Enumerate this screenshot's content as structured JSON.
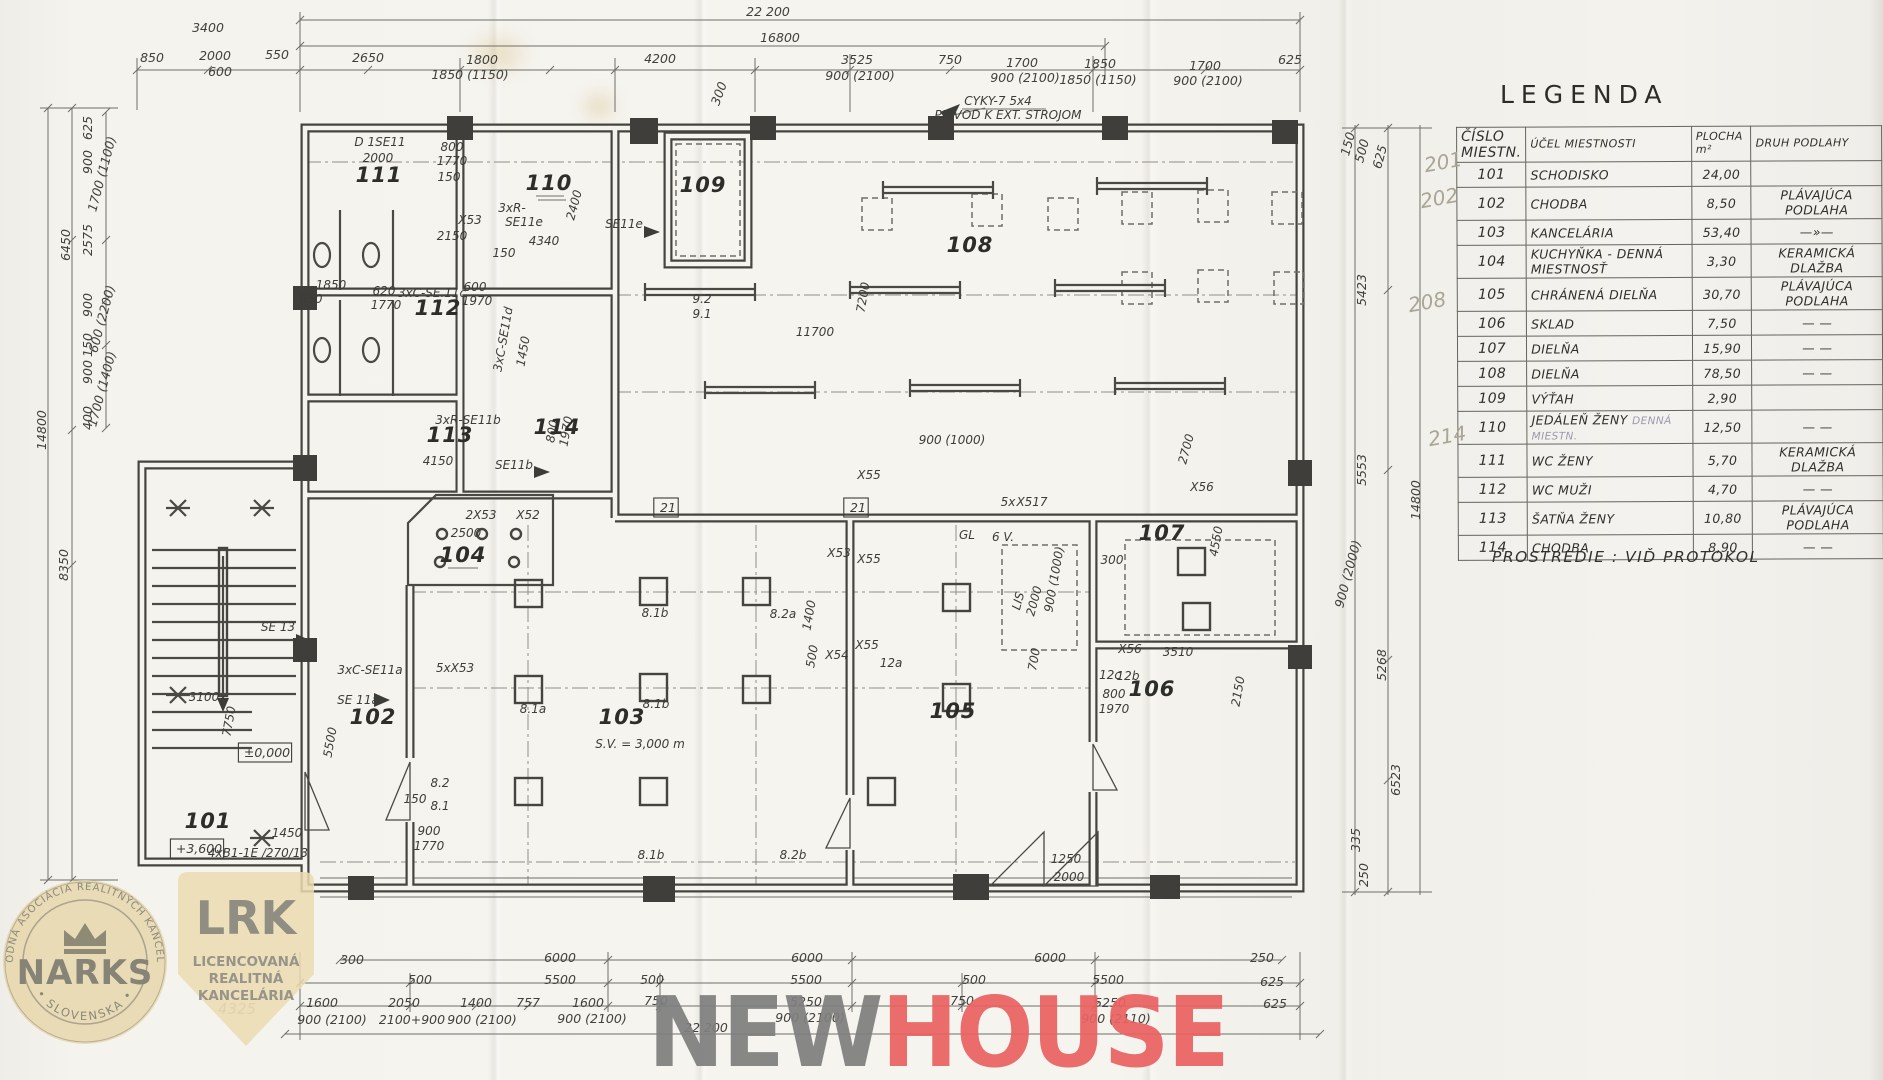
{
  "scan": {
    "width": 1883,
    "height": 1080,
    "kind": "hand-drawn floor plan"
  },
  "legend": {
    "title": "LEGENDA",
    "note": "PROSTREDIE : VIĎ PROTOKOL",
    "headers": {
      "c1l1": "ČÍSLO",
      "c1l2": "MIESTN.",
      "c2": "ÚČEL MIESTNOSTI",
      "c3l1": "PLOCHA",
      "c3l2": "m²",
      "c4": "DRUH PODLAHY"
    },
    "rows": [
      {
        "n": "101",
        "p": "SCHODISKO",
        "a": "24,00",
        "f": ""
      },
      {
        "n": "102",
        "p": "CHODBA",
        "a": "8,50",
        "f": "PLÁVAJÚCA PODLAHA"
      },
      {
        "n": "103",
        "p": "KANCELÁRIA",
        "a": "53,40",
        "f": "—»—"
      },
      {
        "n": "104",
        "p": "KUCHYŇKA - DENNÁ MIESTNOSŤ",
        "a": "3,30",
        "f": "KERAMICKÁ DLAŽBA"
      },
      {
        "n": "105",
        "p": "CHRÁNENÁ DIELŇA",
        "a": "30,70",
        "f": "PLÁVAJÚCA PODLAHA"
      },
      {
        "n": "106",
        "p": "SKLAD",
        "a": "7,50",
        "f": "— —"
      },
      {
        "n": "107",
        "p": "DIELŇA",
        "a": "15,90",
        "f": "— —"
      },
      {
        "n": "108",
        "p": "DIELŇA",
        "a": "78,50",
        "f": "— —"
      },
      {
        "n": "109",
        "p": "VÝŤAH",
        "a": "2,90",
        "f": ""
      },
      {
        "n": "110",
        "p": "JEDÁLEŇ ŽENY",
        "pen": "DENNÁ MIESTN.",
        "a": "12,50",
        "f": "— —"
      },
      {
        "n": "111",
        "p": "WC ŽENY",
        "a": "5,70",
        "f": "KERAMICKÁ DLAŽBA"
      },
      {
        "n": "112",
        "p": "WC MUŽI",
        "a": "4,70",
        "f": "— —"
      },
      {
        "n": "113",
        "p": "ŠATŇA ŽENY",
        "a": "10,80",
        "f": "PLÁVAJÚCA PODLAHA"
      },
      {
        "n": "114",
        "p": "CHODBA",
        "a": "8,90",
        "f": "— —"
      }
    ],
    "margin_notes": [
      {
        "t": "201",
        "x": 1424,
        "y": 150
      },
      {
        "t": "202",
        "x": 1420,
        "y": 186
      },
      {
        "t": "208",
        "x": 1408,
        "y": 290
      },
      {
        "t": "214",
        "x": 1428,
        "y": 424
      }
    ]
  },
  "plan": {
    "labels": [
      [
        "22 200",
        768,
        16,
        "dim"
      ],
      [
        "16800",
        780,
        42,
        "dim"
      ],
      [
        "3400",
        208,
        32,
        "dim"
      ],
      [
        "850",
        152,
        62,
        "dim"
      ],
      [
        "2000",
        215,
        60,
        "dim"
      ],
      [
        "600",
        220,
        76,
        "dim"
      ],
      [
        "550",
        277,
        59,
        "dim"
      ],
      [
        "2650",
        368,
        62,
        "dim"
      ],
      [
        "1800",
        482,
        64,
        "dim"
      ],
      [
        "1850 (1150)",
        470,
        79,
        "dim"
      ],
      [
        "4200",
        660,
        63,
        "dim"
      ],
      [
        "3525",
        857,
        64,
        "dim"
      ],
      [
        "900 (2100)",
        860,
        80,
        "dim"
      ],
      [
        "750",
        950,
        64,
        "dim"
      ],
      [
        "1700",
        1022,
        67,
        "dim"
      ],
      [
        "900 (2100)",
        1025,
        82,
        "dim"
      ],
      [
        "1850",
        1100,
        68,
        "dim"
      ],
      [
        "1850 (1150)",
        1098,
        84,
        "dim"
      ],
      [
        "1700",
        1205,
        70,
        "dim"
      ],
      [
        "900 (2100)",
        1208,
        85,
        "dim"
      ],
      [
        "625",
        1290,
        64,
        "dim"
      ],
      [
        "300",
        723,
        95,
        "dim",
        -70
      ],
      [
        "14800",
        46,
        430,
        "dim",
        -90
      ],
      [
        "6450",
        70,
        245,
        "dim",
        -90
      ],
      [
        "8350",
        68,
        565,
        "dim",
        -90
      ],
      [
        "625",
        92,
        128,
        "dim",
        -90
      ],
      [
        "900",
        92,
        162,
        "dim",
        -90
      ],
      [
        "1700 (1100)",
        106,
        175,
        "dim",
        -75
      ],
      [
        "2575",
        92,
        240,
        "dim",
        -90
      ],
      [
        "900",
        92,
        305,
        "dim",
        -90
      ],
      [
        "600 (2200)",
        106,
        320,
        "dim",
        -75
      ],
      [
        "150",
        92,
        345,
        "dim",
        -90
      ],
      [
        "900",
        92,
        372,
        "dim",
        -90
      ],
      [
        "1700 (1400)",
        106,
        390,
        "dim",
        -75
      ],
      [
        "400",
        92,
        418,
        "dim",
        -90
      ],
      [
        "150",
        1352,
        145,
        "dim",
        -75
      ],
      [
        "500",
        1366,
        152,
        "dim",
        -75
      ],
      [
        "625",
        1384,
        158,
        "dim",
        -75
      ],
      [
        "5423",
        1366,
        290,
        "dim",
        -90
      ],
      [
        "5553",
        1366,
        470,
        "dim",
        -90
      ],
      [
        "900 (2000)",
        1352,
        575,
        "dim",
        -75
      ],
      [
        "14800",
        1420,
        500,
        "dim",
        -90
      ],
      [
        "5268",
        1386,
        665,
        "dim",
        -90
      ],
      [
        "6523",
        1400,
        780,
        "dim",
        -90
      ],
      [
        "335",
        1360,
        840,
        "dim",
        -90
      ],
      [
        "250",
        1368,
        875,
        "dim",
        -90
      ],
      [
        "6000",
        560,
        962,
        "dim"
      ],
      [
        "6000",
        807,
        962,
        "dim"
      ],
      [
        "6000",
        1050,
        962,
        "dim"
      ],
      [
        "300",
        352,
        964,
        "dim"
      ],
      [
        "250",
        1262,
        962,
        "dim"
      ],
      [
        "500",
        420,
        984,
        "dim"
      ],
      [
        "5500",
        560,
        984,
        "dim"
      ],
      [
        "500",
        652,
        984,
        "dim"
      ],
      [
        "5500",
        806,
        984,
        "dim"
      ],
      [
        "500",
        974,
        984,
        "dim"
      ],
      [
        "5500",
        1108,
        984,
        "dim"
      ],
      [
        "625",
        1272,
        986,
        "dim"
      ],
      [
        "1600",
        322,
        1007,
        "dim"
      ],
      [
        "900 (2100)",
        332,
        1024,
        "dim"
      ],
      [
        "2050",
        404,
        1007,
        "dim"
      ],
      [
        "2100+900",
        412,
        1024,
        "dim"
      ],
      [
        "1400",
        476,
        1007,
        "dim"
      ],
      [
        "900 (2100)",
        482,
        1024,
        "dim"
      ],
      [
        "757",
        528,
        1007,
        "dim"
      ],
      [
        "1600",
        588,
        1007,
        "dim"
      ],
      [
        "900 (2100)",
        592,
        1023,
        "dim"
      ],
      [
        "750",
        656,
        1005,
        "dim"
      ],
      [
        "5250",
        806,
        1006,
        "dim"
      ],
      [
        "900 (2100)",
        810,
        1022,
        "dim"
      ],
      [
        "750",
        962,
        1005,
        "dim"
      ],
      [
        "5250",
        1110,
        1007,
        "dim"
      ],
      [
        "900 (2110)",
        1116,
        1023,
        "dim"
      ],
      [
        "625",
        1275,
        1008,
        "dim"
      ],
      [
        "22 200",
        706,
        1032,
        "dim"
      ],
      [
        "4325",
        237,
        1014,
        "pen"
      ],
      [
        "D 1SE11",
        380,
        146,
        "ann"
      ],
      [
        "2000",
        378,
        162,
        "ann"
      ],
      [
        "800",
        452,
        151,
        "ann"
      ],
      [
        "1770",
        452,
        165,
        "ann"
      ],
      [
        "150",
        449,
        181,
        "ann"
      ],
      [
        "3xR-",
        512,
        212,
        "ann"
      ],
      [
        "SE11e",
        524,
        226,
        "ann"
      ],
      [
        "X53",
        470,
        224,
        "ann"
      ],
      [
        "2150",
        452,
        240,
        "ann"
      ],
      [
        "4340",
        544,
        245,
        "ann"
      ],
      [
        "150",
        504,
        257,
        "ann"
      ],
      [
        "2400",
        578,
        206,
        "ann",
        -75
      ],
      [
        "SE11e",
        624,
        228,
        "ann"
      ],
      [
        "9.2",
        702,
        303,
        "ann"
      ],
      [
        "9.1",
        702,
        318,
        "ann"
      ],
      [
        "CYKY-7 5x4",
        998,
        105,
        "ann"
      ],
      [
        "PRÍVOD K EXT. STROJOM",
        1008,
        119,
        "ann"
      ],
      [
        "11700",
        815,
        336,
        "ann"
      ],
      [
        "7200",
        867,
        298,
        "ann",
        -80
      ],
      [
        "3xC-SE.11c",
        432,
        297,
        "ann"
      ],
      [
        "600",
        475,
        291,
        "ann"
      ],
      [
        "1970",
        477,
        305,
        "ann"
      ],
      [
        "620",
        384,
        295,
        "ann"
      ],
      [
        "1770",
        386,
        309,
        "ann"
      ],
      [
        "1850",
        331,
        289,
        "ann"
      ],
      [
        "850",
        311,
        303,
        "ann"
      ],
      [
        "3xR-SE11b",
        468,
        424,
        "ann"
      ],
      [
        "4150",
        438,
        465,
        "ann"
      ],
      [
        "SE11b",
        514,
        469,
        "ann"
      ],
      [
        "3xC-SE11d",
        507,
        340,
        "ann",
        -80
      ],
      [
        "1450",
        527,
        352,
        "ann",
        -80
      ],
      [
        "800",
        556,
        432,
        "ann",
        -80
      ],
      [
        "1970",
        570,
        432,
        "ann",
        -80
      ],
      [
        "2500",
        466,
        537,
        "ann"
      ],
      [
        "2X53",
        481,
        519,
        "ann"
      ],
      [
        "X52",
        528,
        519,
        "ann"
      ],
      [
        "5xX53",
        455,
        672,
        "ann"
      ],
      [
        "SE 11a",
        358,
        704,
        "ann"
      ],
      [
        "3xC-SE11a",
        370,
        674,
        "ann"
      ],
      [
        "5500",
        334,
        743,
        "ann",
        -80
      ],
      [
        "SE 13",
        278,
        631,
        "ann"
      ],
      [
        "3100",
        204,
        701,
        "ann"
      ],
      [
        "7750",
        233,
        722,
        "ann",
        -80
      ],
      [
        "±0,000",
        267,
        757,
        "box"
      ],
      [
        "+3,600",
        199,
        853,
        "box"
      ],
      [
        "4xB1-1E /270/13",
        258,
        857,
        "ann"
      ],
      [
        "1450",
        287,
        837,
        "ann"
      ],
      [
        "8.2",
        440,
        787,
        "ann"
      ],
      [
        "8.1",
        440,
        810,
        "ann"
      ],
      [
        "150",
        415,
        803,
        "ann"
      ],
      [
        "900",
        429,
        835,
        "ann"
      ],
      [
        "1770",
        429,
        850,
        "ann"
      ],
      [
        "8.1a",
        533,
        713,
        "ann"
      ],
      [
        "8.1b",
        656,
        708,
        "ann"
      ],
      [
        "8.1b",
        655,
        617,
        "ann"
      ],
      [
        "8.2a",
        783,
        618,
        "ann"
      ],
      [
        "8.1b",
        651,
        859,
        "ann"
      ],
      [
        "8.2b",
        793,
        859,
        "ann"
      ],
      [
        "X55",
        869,
        479,
        "ann"
      ],
      [
        "X55",
        869,
        563,
        "ann"
      ],
      [
        "X55",
        867,
        649,
        "ann"
      ],
      [
        "X54",
        837,
        659,
        "ann"
      ],
      [
        "12a",
        891,
        667,
        "ann"
      ],
      [
        "X53",
        839,
        557,
        "ann"
      ],
      [
        "21",
        858,
        512,
        "box"
      ],
      [
        "21",
        668,
        512,
        "box"
      ],
      [
        "5x",
        1008,
        506,
        "ann"
      ],
      [
        "X517",
        1032,
        506,
        "ann"
      ],
      [
        "GL",
        967,
        539,
        "ann"
      ],
      [
        "6 V.",
        1003,
        541,
        "ann"
      ],
      [
        "LIS",
        1022,
        602,
        "ann",
        -75
      ],
      [
        "2000",
        1038,
        602,
        "ann",
        -75
      ],
      [
        "900 (1000)",
        1058,
        580,
        "ann",
        -80
      ],
      [
        "900 (1000)",
        952,
        444,
        "ann"
      ],
      [
        "1400",
        813,
        616,
        "ann",
        -80
      ],
      [
        "500",
        816,
        657,
        "ann",
        -80
      ],
      [
        "300",
        1112,
        564,
        "ann"
      ],
      [
        "X56",
        1130,
        653,
        "ann"
      ],
      [
        "12b",
        1128,
        680,
        "ann"
      ],
      [
        "2700",
        1190,
        450,
        "ann",
        -75
      ],
      [
        "X56",
        1202,
        491,
        "ann"
      ],
      [
        "4550",
        1220,
        542,
        "ann",
        -80
      ],
      [
        "700",
        1038,
        660,
        "ann",
        -80
      ],
      [
        "1250",
        1066,
        863,
        "ann"
      ],
      [
        "2000",
        1069,
        881,
        "ann"
      ],
      [
        "3510",
        1178,
        656,
        "ann"
      ],
      [
        "12c",
        1110,
        679,
        "ann"
      ],
      [
        "800",
        1114,
        698,
        "ann"
      ],
      [
        "1970",
        1114,
        713,
        "ann"
      ],
      [
        "2150",
        1242,
        692,
        "ann",
        -80
      ],
      [
        "S.V. = 3,000 m",
        640,
        748,
        "ann"
      ],
      [
        "101",
        208,
        828,
        "room"
      ],
      [
        "102",
        373,
        724,
        "room"
      ],
      [
        "103",
        622,
        724,
        "room"
      ],
      [
        "104",
        463,
        562,
        "room"
      ],
      [
        "105",
        953,
        718,
        "room"
      ],
      [
        "106",
        1152,
        696,
        "room"
      ],
      [
        "107",
        1162,
        540,
        "room"
      ],
      [
        "108",
        970,
        252,
        "room"
      ],
      [
        "109",
        703,
        192,
        "room"
      ],
      [
        "110",
        549,
        190,
        "room"
      ],
      [
        "111",
        379,
        182,
        "room"
      ],
      [
        "112",
        438,
        315,
        "room"
      ],
      [
        "113",
        450,
        442,
        "room"
      ],
      [
        "114",
        557,
        434,
        "room"
      ]
    ]
  },
  "logos": {
    "narks": {
      "arc_top": "NÁRODNÁ ASOCIÁCIA REALITNÝCH KANCELÁRIÍ",
      "center": "NARKS",
      "arc_bottom": "• SLOVENSKA •",
      "color": "#e7d6a8",
      "text_color": "#8b887b"
    },
    "lrk": {
      "acronym": "LRK",
      "line1": "LICENCOVANÁ",
      "line2": "REALITNÁ",
      "line3": "KANCELÁRIA",
      "color": "#eadbb0",
      "text_color": "#98948a"
    }
  },
  "watermark": {
    "left": "NEW",
    "right": "HOUSE",
    "left_color": "#7f7f7f",
    "right_color": "#ea6262"
  }
}
